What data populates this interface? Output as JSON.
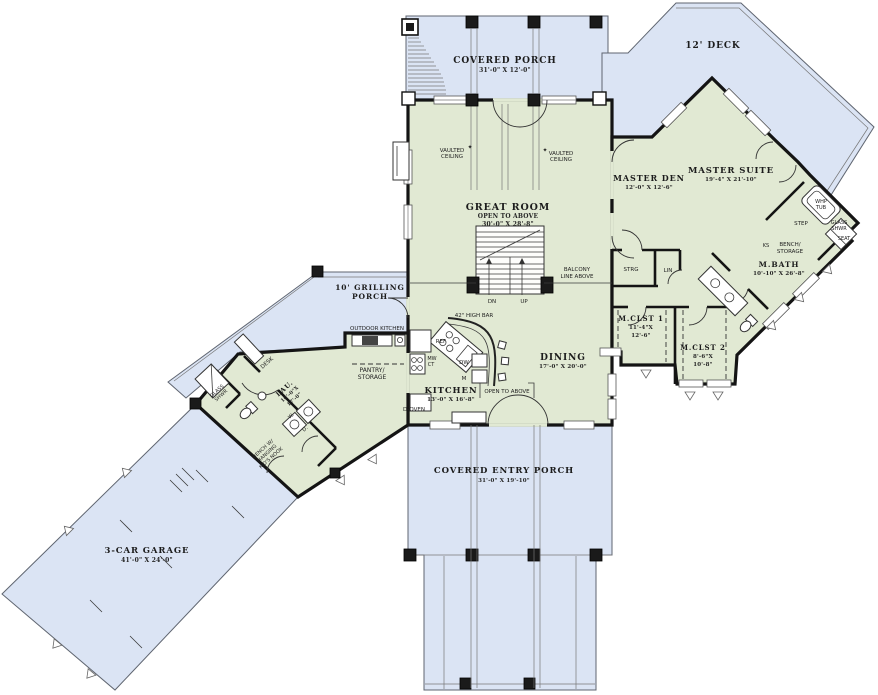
{
  "colors": {
    "porch_blue": "#dbe4f4",
    "interior_green": "#e1e9d3",
    "wall": "#141414"
  },
  "rooms": {
    "covered_porch": {
      "name": "COVERED PORCH",
      "dims": "31'-0\" X 12'-0\""
    },
    "deck": {
      "name": "12' DECK"
    },
    "great_room": {
      "name": "GREAT ROOM",
      "note": "OPEN TO ABOVE",
      "dims": "30'-0\" X 28'-8\""
    },
    "master_den": {
      "name": "MASTER DEN",
      "dims": "12'-0\" X 12'-6\""
    },
    "master_suite": {
      "name": "MASTER SUITE",
      "dims": "19'-4\" X 21'-10\""
    },
    "m_bath": {
      "name": "M.BATH",
      "dims": "10'-10\" X 26'-8\""
    },
    "m_clst_1": {
      "name": "M.CLST 1",
      "dims_line1": "11'-4\"X",
      "dims_line2": "12'-6\""
    },
    "m_clst_2": {
      "name": "M.CLST 2",
      "dims_line1": "8'-6\"X",
      "dims_line2": "10'-8\""
    },
    "dining": {
      "name": "DINING",
      "dims": "17'-0\" X 20'-0\""
    },
    "kitchen": {
      "name": "KITCHEN",
      "dims": "13'-0\" X 16'-8\""
    },
    "laundry": {
      "name": "LAU.",
      "dims_line1": "10'-0\"X",
      "dims_line2": "17'-0\""
    },
    "grilling_porch": {
      "name_line1": "10' GRILLING",
      "name_line2": "PORCH"
    },
    "entry_porch": {
      "name": "COVERED ENTRY PORCH",
      "dims": "31'-0\" X 19'-10\""
    },
    "garage": {
      "name": "3-CAR GARAGE",
      "dims": "41'-0\" X 24'-0\""
    }
  },
  "annotations": {
    "vaulted_line1": "VAULTED",
    "vaulted_line2": "CEILING",
    "vaulted_star": "✦",
    "balcony_line1": "BALCONY",
    "balcony_line2": "LINE ABOVE",
    "dn": "DN",
    "up": "UP",
    "high_bar": "42\" HIGH BAR",
    "ref": "REF",
    "mw": "MW",
    "ct": "CT",
    "dw": "DW",
    "m": "M",
    "d_oven": "D-OVEN",
    "open_to_above": "OPEN TO ABOVE",
    "outdoor_kitchen": "OUTDOOR KITCHEN",
    "pantry_line1": "PANTRY/",
    "pantry_line2": "STORAGE",
    "desk": "DESK",
    "glass_line1": "GLASS",
    "glass_line2": "SHWR",
    "washer": "W.",
    "dryer": "D.",
    "bench_line1": "BENCH W/",
    "bench_line2": "HANGING",
    "bench_line3": "KID'S NOOK",
    "strg": "STRG",
    "lin": "LIN",
    "whp_line1": "WHP",
    "whp_line2": "TUB",
    "step": "STEP",
    "seat": "SEAT",
    "ks": "KS",
    "bench_storage_line1": "BENCH/",
    "bench_storage_line2": "STORAGE"
  }
}
